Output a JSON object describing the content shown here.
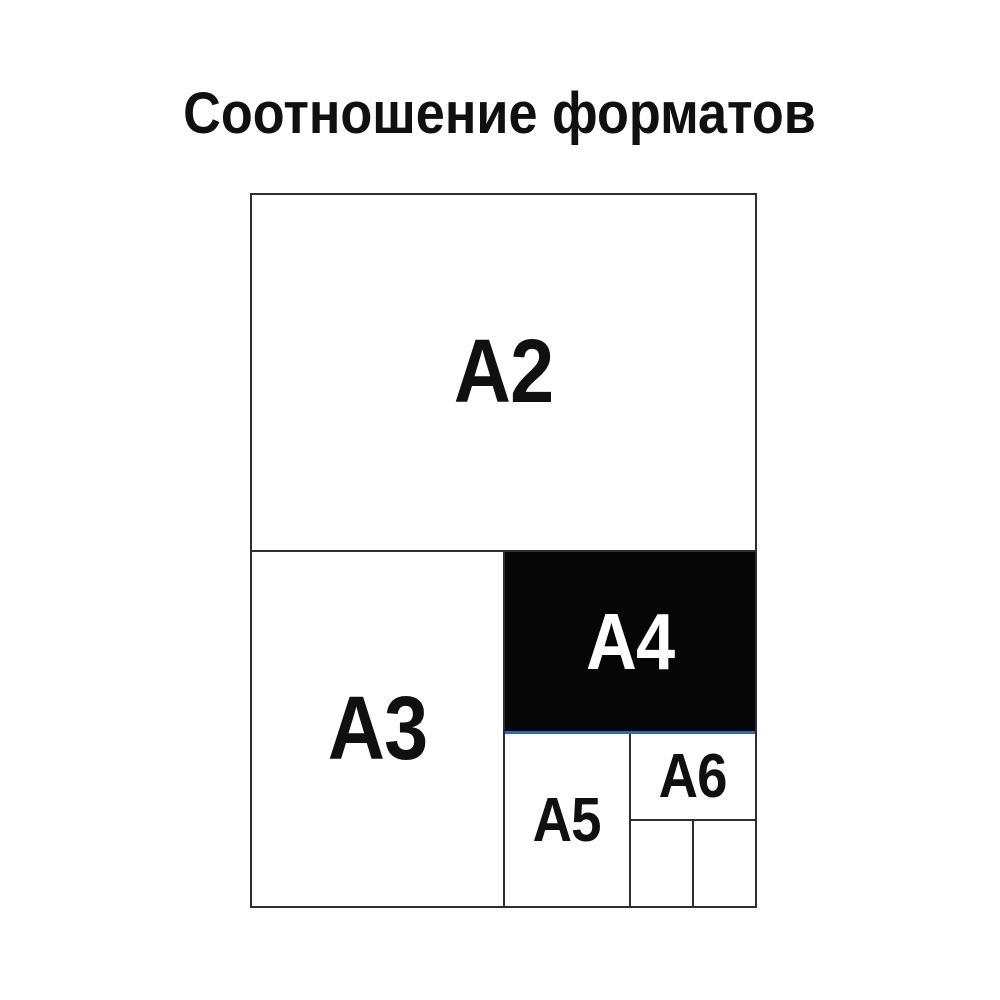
{
  "title": "Соотношение форматов",
  "diagram": {
    "description_labels": {
      "a2": "A2",
      "a3": "A3",
      "a4": "A4",
      "a5": "A5",
      "a6": "A6"
    },
    "highlighted_format": "A4",
    "colors": {
      "line": "#2e2e2e",
      "highlight_fill": "#060606",
      "highlight_label": "#ffffff",
      "accent_line": "#2f6ab4",
      "text": "#101010",
      "background": "#ffffff"
    }
  }
}
